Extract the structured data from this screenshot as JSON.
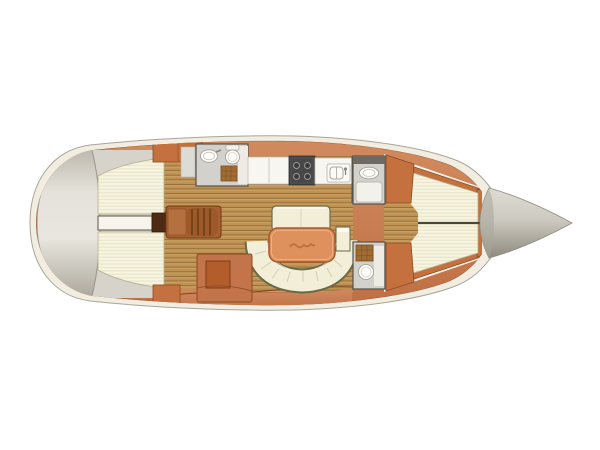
{
  "title": "Sailing yacht interior layout plan (top view)",
  "canvas": {
    "width": 600,
    "height": 450
  },
  "colors": {
    "background": "#ffffff",
    "hull_band": "#f1ede0",
    "hull_outline": "#a8a49a",
    "deck_orange": "#c87e52",
    "deck_outline": "#9a5530",
    "cabinet_orange": "#c4713f",
    "cabinet_outline": "#8a4a22",
    "nav_cabinet": "#c4744a",
    "nav_seat": "#b35c2c",
    "steps_brown": "#a86034",
    "steps_ridge": "#5e3412",
    "engine_dark": "#4e2a12",
    "teak_base": "#c9a05f",
    "cushion_cream": "#f7f4e1",
    "cushion_outline": "#b3af8e",
    "settee_cream": "#f3eed7",
    "settee_outline": "#666a45",
    "table_orange": "#de915d",
    "table_border": "#a85829",
    "head_floor": "#d2d1cb",
    "wall_line": "#57524a",
    "fixture_white": "#fdfdfb",
    "fixture_outline": "#a19d93",
    "grate_brown": "#a06c34",
    "grate_outline": "#7a4f20",
    "stove_dark": "#474747",
    "transom_gray": "#d6d3ca",
    "bow_light": "#dedcd4",
    "bow_dark": "#8e8a7f"
  },
  "vessel": {
    "view": "top-down floor plan",
    "orientation": "stern left, bow right",
    "areas": [
      {
        "id": "transom",
        "label": "Transom / stern platform"
      },
      {
        "id": "aft-cabin-port-berth",
        "label": "Aft cabin double berth (upper)"
      },
      {
        "id": "aft-cabin-stbd-berth",
        "label": "Aft cabin double berth (lower)"
      },
      {
        "id": "aft-aisle",
        "label": "Aisle between aft cabins"
      },
      {
        "id": "engine-compartment",
        "label": "Engine compartment"
      },
      {
        "id": "companionway-steps",
        "label": "Companionway steps"
      },
      {
        "id": "aft-head",
        "label": "Aft head with washbasin, WC and shower grate"
      },
      {
        "id": "galley",
        "label": "Galley with 4-burner stove, counters and double sink"
      },
      {
        "id": "salon",
        "label": "Salon with U-shaped settee, bench and table"
      },
      {
        "id": "nav-station",
        "label": "Navigation station with seat"
      },
      {
        "id": "forward-head-shower",
        "label": "Forward head shower compartment with basin"
      },
      {
        "id": "forward-head-wc",
        "label": "Forward head WC compartment with shower grate"
      },
      {
        "id": "forward-cabin",
        "label": "Forward V-berth cabin with wardrobes"
      },
      {
        "id": "bow",
        "label": "Bow cone / anchor locker"
      }
    ]
  }
}
